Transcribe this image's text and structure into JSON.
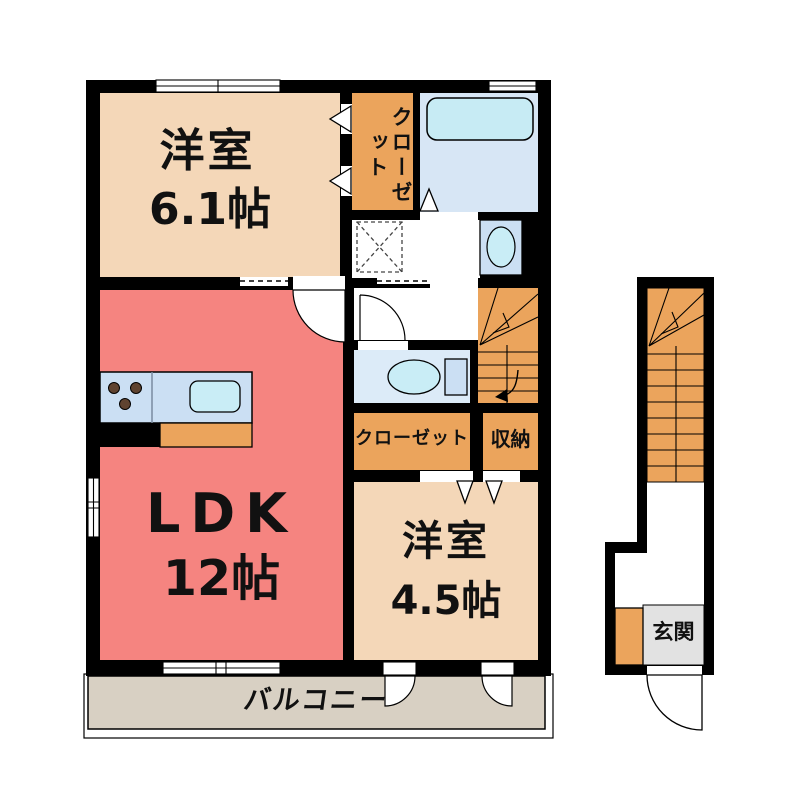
{
  "plan": {
    "bedroom1": {
      "label": "洋室",
      "size": "6.1帖"
    },
    "ldk": {
      "label": "LDK",
      "size": "12帖"
    },
    "bedroom2": {
      "label": "洋室",
      "size": "4.5帖"
    },
    "closet_upper": {
      "label": "クローゼット"
    },
    "closet_lower": {
      "label": "クローゼット"
    },
    "storage": {
      "label": "収納"
    },
    "balcony": {
      "label": "バルコニー"
    },
    "entrance": {
      "label": "玄関"
    }
  },
  "colors": {
    "wall": "#000000",
    "bedroom_floor": "#f4d7b8",
    "ldk_floor": "#f58480",
    "closet_fill": "#eba45c",
    "stairs_fill": "#eba45c",
    "bath_floor": "#d7e6f5",
    "bathtub_fill": "#c7ebf4",
    "toilet_floor": "#dcebf8",
    "counter_fill": "#cbdff3",
    "fixture_blue": "#c9edf6",
    "balcony_floor": "#d8d0c3",
    "entrance_floor": "#e2e2e2",
    "burner_dot": "#5f4330"
  }
}
